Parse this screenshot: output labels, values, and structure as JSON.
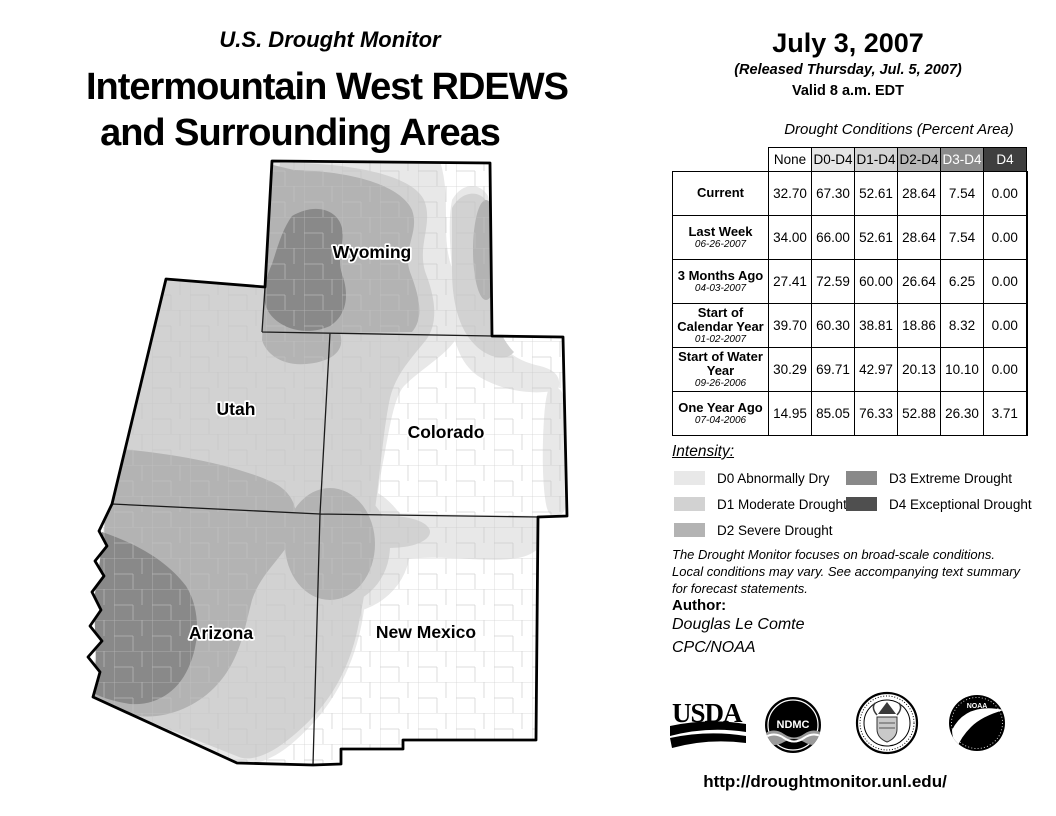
{
  "header": {
    "supertitle": "U.S. Drought Monitor",
    "title_line1": "Intermountain West RDEWS",
    "title_line2": "and Surrounding Areas"
  },
  "date_panel": {
    "date": "July 3, 2007",
    "released": "(Released Thursday, Jul. 5, 2007)",
    "valid": "Valid 8 a.m. EDT"
  },
  "map": {
    "labels": {
      "wyoming": "Wyoming",
      "utah": "Utah",
      "colorado": "Colorado",
      "arizona": "Arizona",
      "new_mexico": "New Mexico"
    }
  },
  "table": {
    "caption": "Drought Conditions (Percent Area)",
    "columns": [
      "None",
      "D0-D4",
      "D1-D4",
      "D2-D4",
      "D3-D4",
      "D4"
    ],
    "rows": [
      {
        "label": "Current",
        "date": "",
        "values": [
          "32.70",
          "67.30",
          "52.61",
          "28.64",
          "7.54",
          "0.00"
        ]
      },
      {
        "label": "Last Week",
        "date": "06-26-2007",
        "values": [
          "34.00",
          "66.00",
          "52.61",
          "28.64",
          "7.54",
          "0.00"
        ]
      },
      {
        "label": "3 Months Ago",
        "date": "04-03-2007",
        "values": [
          "27.41",
          "72.59",
          "60.00",
          "26.64",
          "6.25",
          "0.00"
        ]
      },
      {
        "label": "Start of Calendar Year",
        "date": "01-02-2007",
        "values": [
          "39.70",
          "60.30",
          "38.81",
          "18.86",
          "8.32",
          "0.00"
        ]
      },
      {
        "label": "Start of Water Year",
        "date": "09-26-2006",
        "values": [
          "30.29",
          "69.71",
          "42.97",
          "20.13",
          "10.10",
          "0.00"
        ]
      },
      {
        "label": "One Year Ago",
        "date": "07-04-2006",
        "values": [
          "14.95",
          "85.05",
          "76.33",
          "52.88",
          "26.30",
          "3.71"
        ]
      }
    ]
  },
  "legend": {
    "heading": "Intensity:",
    "items": [
      {
        "code": "D0",
        "label": "D0 Abnormally Dry",
        "color": "#e8e8e8"
      },
      {
        "code": "D1",
        "label": "D1 Moderate Drought",
        "color": "#d2d2d2"
      },
      {
        "code": "D2",
        "label": "D2 Severe Drought",
        "color": "#b3b3b3"
      },
      {
        "code": "D3",
        "label": "D3 Extreme Drought",
        "color": "#898989"
      },
      {
        "code": "D4",
        "label": "D4 Exceptional Drought",
        "color": "#4f4f4f"
      }
    ]
  },
  "notes": {
    "line1": "The Drought Monitor focuses on broad-scale conditions.",
    "line2": "Local conditions may vary. See accompanying text summary",
    "line3": "for forecast statements."
  },
  "author": {
    "heading": "Author:",
    "name": "Douglas Le Comte",
    "org": "CPC/NOAA"
  },
  "logos": {
    "usda": "USDA",
    "ndmc": "NDMC",
    "noaa": "NOAA"
  },
  "footer": {
    "url": "http://droughtmonitor.unl.edu/"
  }
}
